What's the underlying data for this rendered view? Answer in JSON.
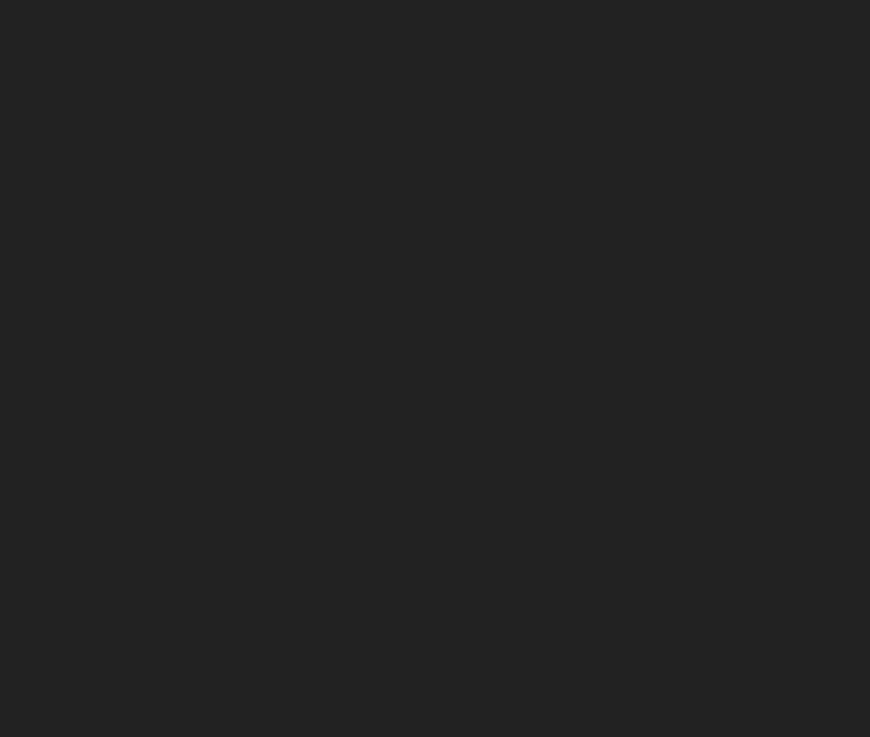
{
  "scene": {
    "label": "Aerial 3D architectural render: white organic-shaped mall with dark inner courtyard, parking lots with cars, roads, lawns, apartment slabs and a golden geodesic dome pavilion",
    "width": 870,
    "height": 737
  },
  "palette": {
    "lawn": "#a5b342",
    "lawnBright": "#b4c24e",
    "road": "#aeb0b3",
    "roadLight": "#bcbec0",
    "asphalt": "#b6b8bb",
    "pale": "#c9cbcc",
    "plazaWhite": "#eef0f0",
    "pathWhite": "#e9eaea",
    "tan": "#dcae5e",
    "tanLine": "#c09a4c",
    "beige": "#ecdfb2",
    "cream": "#f0e7c6",
    "soil": "#54402a",
    "hedge": "#76883a",
    "mallWhite": "#f2f4f5",
    "courtyard": "#2a2622",
    "courtPath": "#8a7950",
    "slabDark": "#3c4248",
    "facadeBeige": "#ddd5ba",
    "facadeDark": "#49515b",
    "white": "#f4f5f5",
    "domeGold": "#7c6a38",
    "domeMid": "#5a4d2e",
    "domeDark": "#3f3a2f",
    "goldLine": "#d2ab52",
    "grayDome": "#90959d",
    "shadowLawn": "rgba(20,30,22,0.52)",
    "shadowCool": "rgba(34,42,62,0.50)",
    "edgeLine": "#e8e7e2"
  },
  "carColors": {
    "red": "#b3202a",
    "black": "#23262b",
    "white": "#e9eaeb",
    "silver": "#a9afb4",
    "yellow": "#c9c13f",
    "green": "#50734a",
    "blue": "#33507e"
  },
  "roadCars": [
    [
      152,
      368,
      74,
      "red"
    ],
    [
      153,
      386,
      74,
      "white"
    ],
    [
      178,
      396,
      74,
      "black"
    ],
    [
      167,
      457,
      74,
      "white"
    ],
    [
      200,
      448,
      74,
      "red"
    ],
    [
      202,
      470,
      74,
      "black"
    ],
    [
      216,
      512,
      60,
      "white"
    ],
    [
      57,
      612,
      -10,
      "white"
    ],
    [
      20,
      657,
      -10,
      "white"
    ],
    [
      37,
      634,
      -10,
      "red"
    ],
    [
      62,
      643,
      -10,
      "black"
    ],
    [
      107,
      612,
      -10,
      "red"
    ],
    [
      143,
      621,
      -10,
      "black"
    ],
    [
      157,
      606,
      -10,
      "white"
    ],
    [
      171,
      612,
      -10,
      "black"
    ],
    [
      176,
      600,
      -10,
      "white"
    ],
    [
      293,
      516,
      -4,
      "white"
    ],
    [
      312,
      528,
      -4,
      "yellow"
    ],
    [
      317,
      509,
      -4,
      "black"
    ],
    [
      342,
      532,
      -4,
      "black"
    ],
    [
      355,
      515,
      -4,
      "silver"
    ],
    [
      370,
      534,
      -4,
      "red"
    ],
    [
      397,
      497,
      -4,
      "red"
    ],
    [
      428,
      488,
      -3,
      "yellow"
    ],
    [
      423,
      518,
      -3,
      "blue"
    ],
    [
      498,
      499,
      -2,
      "red"
    ],
    [
      543,
      517,
      2,
      "green"
    ],
    [
      582,
      528,
      4,
      "red"
    ],
    [
      632,
      521,
      8,
      "white"
    ],
    [
      658,
      585,
      14,
      "black"
    ],
    [
      688,
      573,
      16,
      "silver"
    ],
    [
      604,
      147,
      -8,
      "black"
    ],
    [
      615,
      151,
      -8,
      "black"
    ],
    [
      627,
      155,
      -8,
      "silver"
    ]
  ],
  "parking": {
    "angle": -8,
    "stall": 9,
    "rows": [
      {
        "x": 637,
        "y": 205,
        "len": 62,
        "top": [
          "red",
          "red",
          null,
          "black",
          null,
          "white"
        ],
        "bot": [
          "white",
          null,
          "black",
          "red",
          null
        ]
      },
      {
        "x": 620,
        "y": 241,
        "len": 84,
        "top": [
          "yellow",
          "white",
          null,
          "red",
          "red",
          "black",
          null,
          "silver",
          "red"
        ],
        "bot": [
          "red",
          null,
          "white",
          "black",
          "red",
          null,
          "black",
          null,
          "white"
        ]
      },
      {
        "x": 606,
        "y": 282,
        "len": 92,
        "top": [
          "red",
          "white",
          "red",
          null,
          "black",
          "silver",
          null,
          "red",
          "black",
          "white"
        ],
        "bot": [
          "white",
          "red",
          null,
          "red",
          "black",
          "white",
          "silver",
          null,
          "red",
          "black"
        ]
      },
      {
        "x": 589,
        "y": 322,
        "len": 94,
        "top": [
          "black",
          "white",
          null,
          "red",
          "silver",
          null,
          "red",
          "black",
          "white",
          "red"
        ],
        "bot": [
          "silver",
          "red",
          "red",
          null,
          "white",
          "black",
          null,
          "red",
          "silver",
          "black"
        ]
      },
      {
        "x": 583,
        "y": 361,
        "len": 82,
        "top": [
          "yellow",
          "silver",
          null,
          "red",
          "black",
          "white",
          null,
          "red",
          "black"
        ],
        "bot": [
          "white",
          null,
          "red",
          "red",
          "black",
          null,
          "silver",
          "red"
        ]
      },
      {
        "x": 573,
        "y": 400,
        "len": 80,
        "top": [
          "white",
          "silver",
          "red",
          null,
          "red",
          "black",
          null,
          "red"
        ],
        "bot": [
          "black",
          null,
          "yellow",
          "silver",
          "red",
          "black",
          null,
          "white"
        ]
      },
      {
        "x": 563,
        "y": 440,
        "len": 78,
        "top": [
          "silver",
          "red",
          null,
          "red",
          "black",
          "red",
          null,
          "black"
        ],
        "bot": [
          "red",
          "white",
          "black",
          null,
          "red",
          "white",
          "red"
        ]
      }
    ]
  },
  "treeTones": [
    {
      "b": "#2e4b1d",
      "h": "#5d8a2b"
    },
    {
      "b": "#17260f",
      "h": "#27401a"
    },
    {
      "b": "#1f3a14",
      "h": "#37591f"
    },
    {
      "b": "#6b5c33",
      "h": "#c8a84e"
    }
  ],
  "trees": [
    [
      88,
      8,
      7,
      0
    ],
    [
      96,
      28,
      7,
      0
    ],
    [
      103,
      47,
      7,
      0
    ],
    [
      110,
      66,
      7,
      0
    ],
    [
      117,
      85,
      7,
      0
    ],
    [
      124,
      104,
      7,
      0
    ],
    [
      131,
      124,
      7,
      0
    ],
    [
      138,
      144,
      7,
      0
    ],
    [
      145,
      164,
      7,
      0
    ],
    [
      152,
      184,
      6,
      0
    ],
    [
      159,
      204,
      6,
      0
    ],
    [
      166,
      226,
      5,
      0
    ],
    [
      172,
      248,
      5,
      0
    ],
    [
      179,
      271,
      5,
      0
    ],
    [
      173,
      252,
      6,
      0
    ],
    [
      180,
      272,
      6,
      0
    ],
    [
      187,
      293,
      6,
      0
    ],
    [
      194,
      314,
      6,
      0
    ],
    [
      202,
      336,
      6,
      0
    ],
    [
      206,
      264,
      6,
      0
    ],
    [
      213,
      285,
      6,
      0
    ],
    [
      220,
      307,
      6,
      0
    ],
    [
      227,
      329,
      6,
      0
    ],
    [
      233,
      351,
      6,
      0
    ],
    [
      224,
      384,
      6,
      0
    ],
    [
      231,
      404,
      6,
      0
    ],
    [
      238,
      423,
      6,
      0
    ],
    [
      245,
      441,
      6,
      0
    ],
    [
      250,
      458,
      5,
      2
    ],
    [
      256,
      474,
      5,
      2
    ],
    [
      195,
      235,
      4,
      3
    ],
    [
      205,
      248,
      4,
      3
    ],
    [
      215,
      238,
      4,
      3
    ],
    [
      225,
      252,
      4,
      3
    ],
    [
      235,
      242,
      4,
      3
    ],
    [
      245,
      256,
      4,
      3
    ],
    [
      255,
      246,
      4,
      3
    ],
    [
      265,
      258,
      4,
      3
    ],
    [
      275,
      248,
      4,
      3
    ],
    [
      283,
      260,
      4,
      3
    ],
    [
      270,
      463,
      5,
      2
    ],
    [
      290,
      464,
      5,
      2
    ],
    [
      310,
      465,
      5,
      2
    ],
    [
      330,
      465,
      5,
      2
    ],
    [
      350,
      466,
      5,
      2
    ],
    [
      370,
      466,
      5,
      2
    ],
    [
      390,
      467,
      5,
      2
    ],
    [
      410,
      467,
      5,
      2
    ],
    [
      430,
      467,
      5,
      2
    ],
    [
      450,
      468,
      5,
      2
    ],
    [
      470,
      468,
      5,
      2
    ],
    [
      490,
      468,
      5,
      2
    ],
    [
      510,
      469,
      5,
      2
    ],
    [
      530,
      469,
      5,
      2
    ],
    [
      550,
      470,
      5,
      2
    ],
    [
      562,
      215,
      4,
      0
    ],
    [
      570,
      235,
      4,
      0
    ],
    [
      566,
      255,
      4,
      0
    ],
    [
      574,
      275,
      4,
      0
    ],
    [
      568,
      295,
      4,
      0
    ],
    [
      576,
      318,
      4,
      0
    ],
    [
      582,
      340,
      4,
      0
    ],
    [
      578,
      362,
      4,
      0
    ],
    [
      588,
      384,
      4,
      0
    ],
    [
      584,
      406,
      4,
      0
    ],
    [
      550,
      150,
      6,
      0
    ],
    [
      563,
      139,
      6,
      0
    ],
    [
      576,
      152,
      6,
      0
    ],
    [
      590,
      141,
      6,
      0
    ],
    [
      604,
      154,
      6,
      0
    ],
    [
      618,
      144,
      6,
      0
    ],
    [
      630,
      158,
      5,
      0
    ],
    [
      557,
      163,
      5,
      0
    ],
    [
      574,
      166,
      5,
      0
    ],
    [
      608,
      167,
      5,
      0
    ],
    [
      660,
      196,
      6,
      0
    ],
    [
      678,
      186,
      6,
      0
    ],
    [
      698,
      208,
      6,
      0
    ],
    [
      716,
      196,
      6,
      0
    ],
    [
      732,
      224,
      6,
      0
    ],
    [
      670,
      228,
      5,
      0
    ],
    [
      694,
      238,
      5,
      0
    ],
    [
      706,
      320,
      5,
      0
    ],
    [
      715,
      345,
      5,
      0
    ],
    [
      709,
      372,
      5,
      0
    ],
    [
      718,
      398,
      5,
      0
    ],
    [
      568,
      690,
      7,
      1
    ],
    [
      585,
      712,
      7,
      1
    ],
    [
      562,
      662,
      6,
      1
    ],
    [
      742,
      642,
      6,
      1
    ],
    [
      760,
      638,
      6,
      1
    ],
    [
      778,
      635,
      6,
      1
    ],
    [
      796,
      632,
      6,
      1
    ],
    [
      814,
      629,
      6,
      1
    ],
    [
      832,
      626,
      6,
      1
    ],
    [
      850,
      623,
      6,
      1
    ],
    [
      864,
      620,
      6,
      1
    ],
    [
      758,
      710,
      7,
      1
    ]
  ]
}
